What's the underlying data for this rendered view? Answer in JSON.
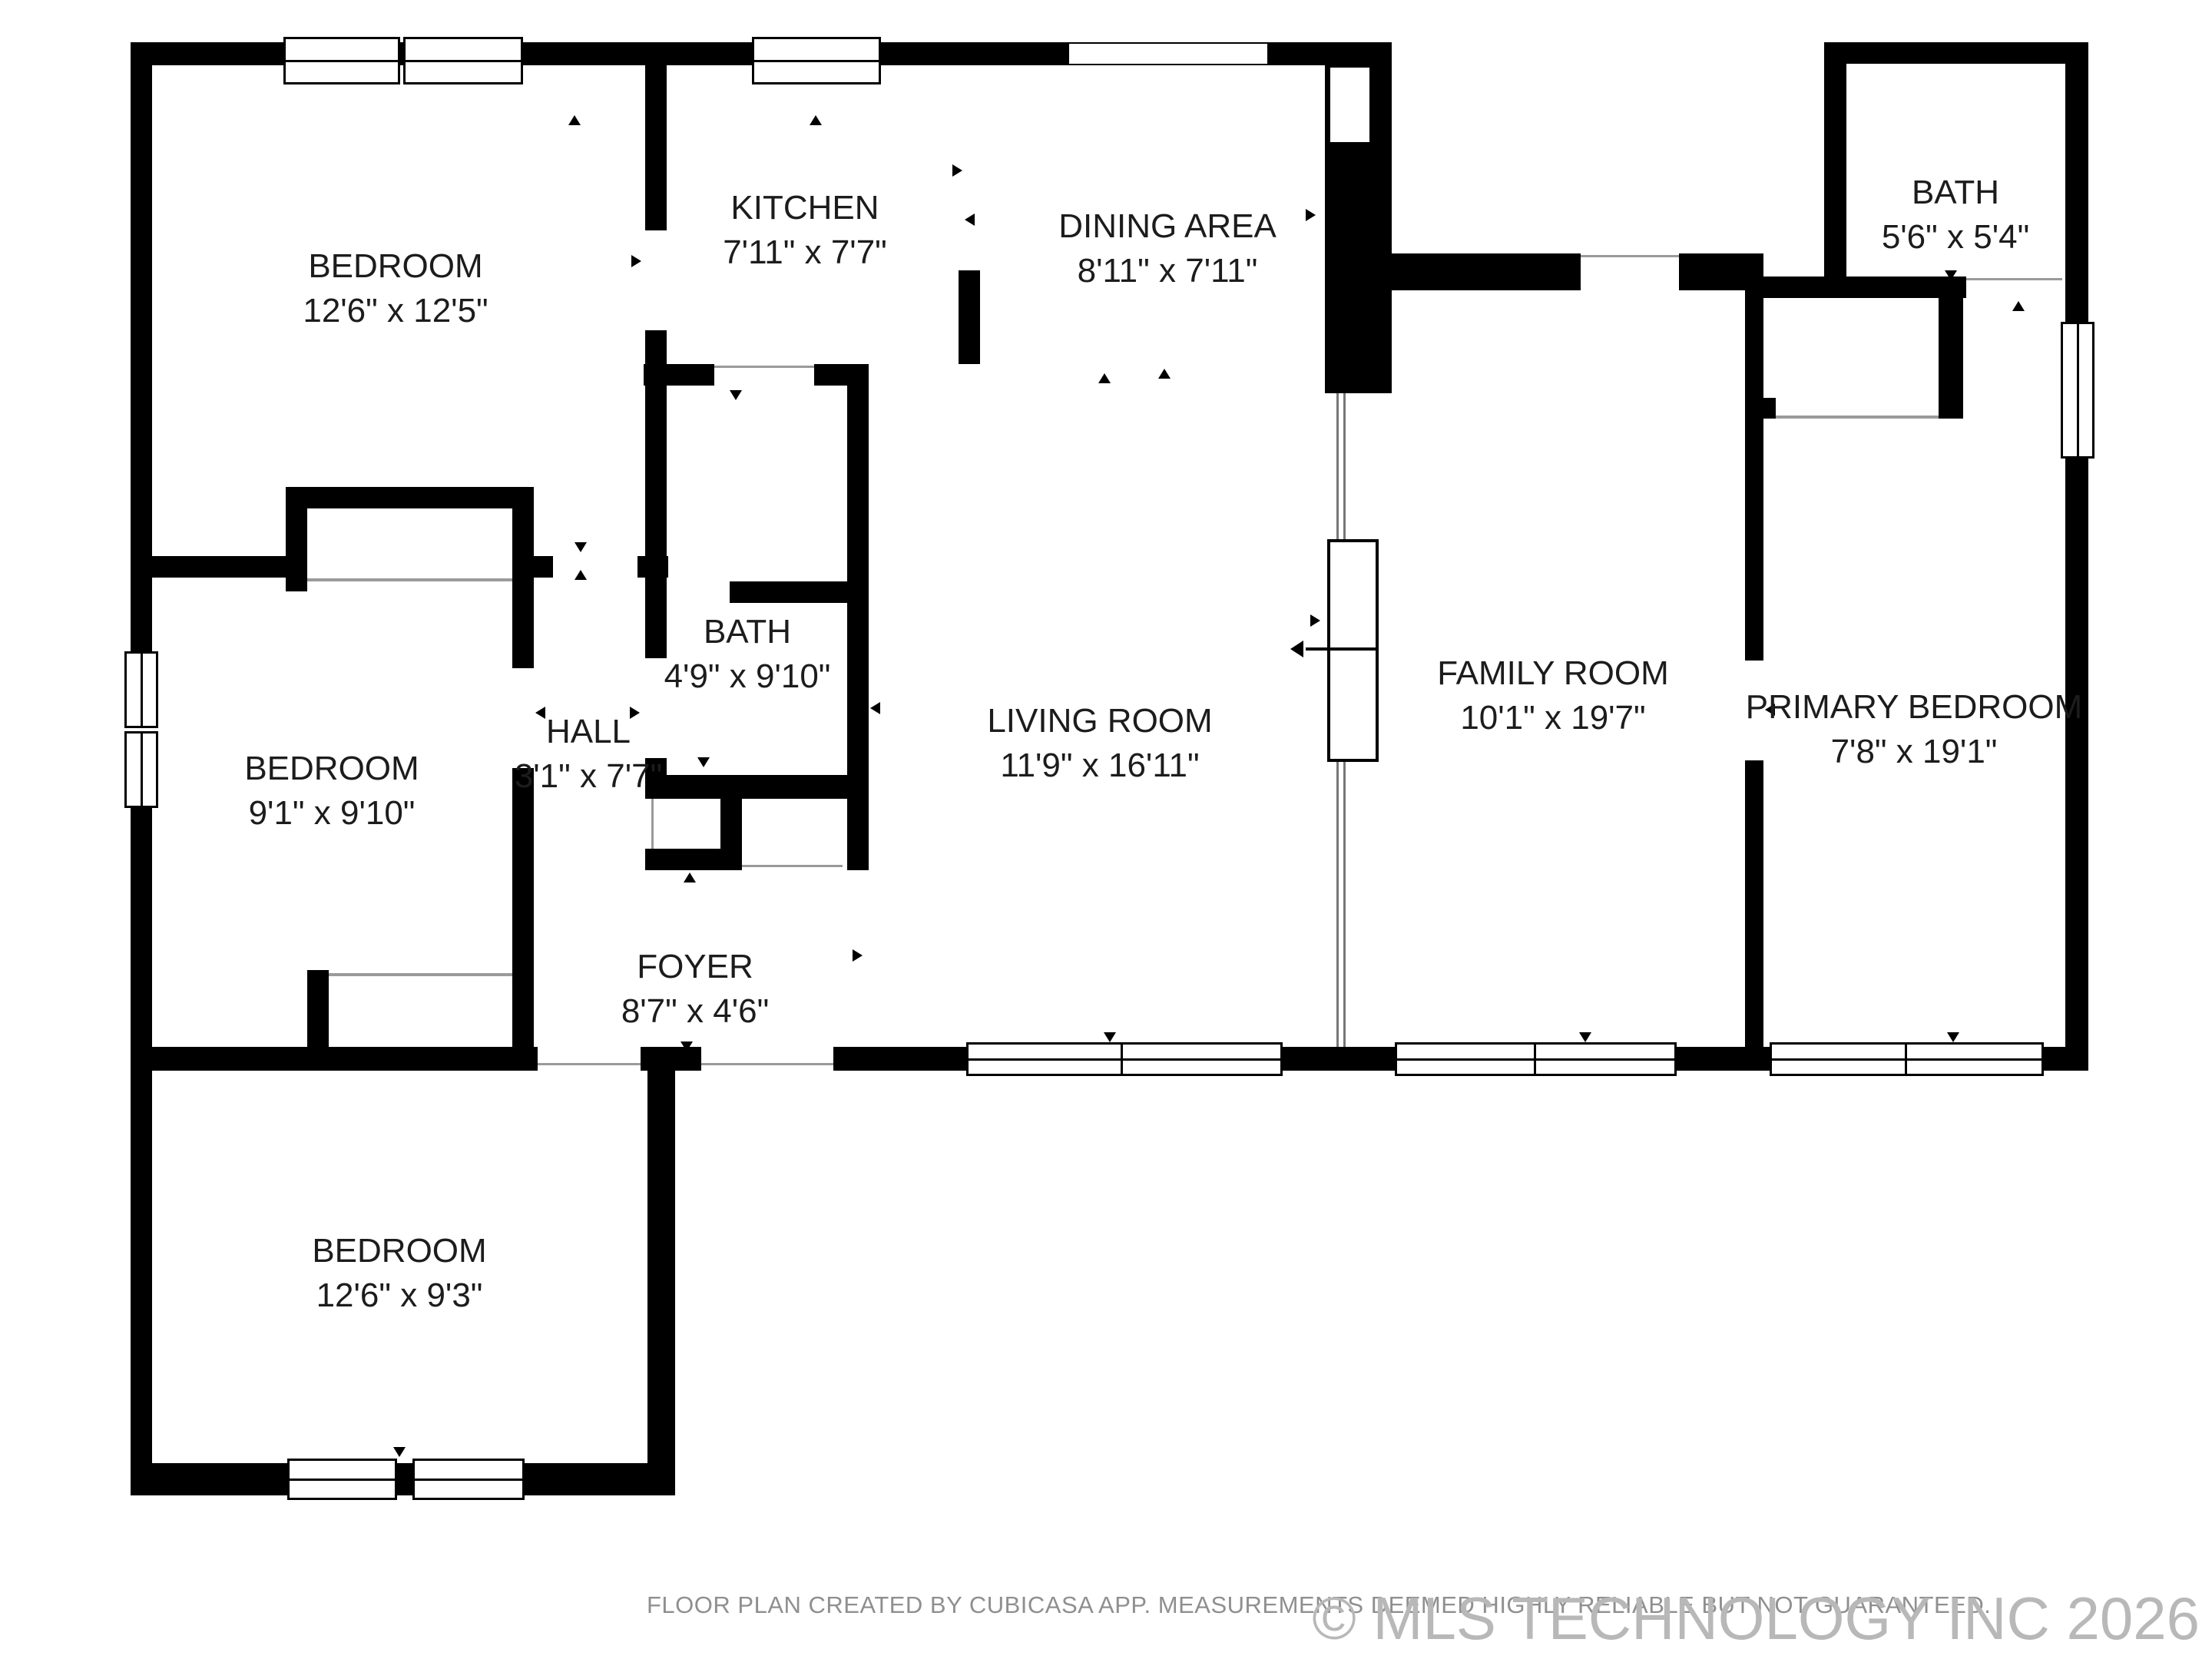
{
  "plan": {
    "type": "floor-plan",
    "rooms": [
      {
        "id": "bedroom-1",
        "name": "BEDROOM",
        "dims": "12'6\" x 12'5\""
      },
      {
        "id": "kitchen",
        "name": "KITCHEN",
        "dims": "7'11\" x 7'7\""
      },
      {
        "id": "dining-area",
        "name": "DINING AREA",
        "dims": "8'11\" x 7'11\""
      },
      {
        "id": "bath-top-right",
        "name": "BATH",
        "dims": "5'6\" x 5'4\""
      },
      {
        "id": "bedroom-2",
        "name": "BEDROOM",
        "dims": "9'1\" x 9'10\""
      },
      {
        "id": "hall",
        "name": "HALL",
        "dims": "3'1\" x 7'7\""
      },
      {
        "id": "bath-hall",
        "name": "BATH",
        "dims": "4'9\" x 9'10\""
      },
      {
        "id": "living-room",
        "name": "LIVING ROOM",
        "dims": "11'9\" x 16'11\""
      },
      {
        "id": "family-room",
        "name": "FAMILY ROOM",
        "dims": "10'1\" x 19'7\""
      },
      {
        "id": "primary-bedroom",
        "name": "PRIMARY BEDROOM",
        "dims": "7'8\" x 19'1\""
      },
      {
        "id": "foyer",
        "name": "FOYER",
        "dims": "8'7\" x 4'6\""
      },
      {
        "id": "bedroom-3",
        "name": "BEDROOM",
        "dims": "12'6\" x 9'3\""
      }
    ],
    "footer": {
      "disclaimer": "FLOOR PLAN CREATED BY CUBICASA APP. MEASUREMENTS DEEMED HIGHLY RELIABLE BUT NOT GUARANTEED.",
      "watermark": "© MLS TECHNOLOGY INC 2026"
    },
    "colors": {
      "wall": "#000000",
      "label": "#1c1c1c",
      "disclaimer": "#8f8f8f",
      "watermark": "#b8b8b8"
    }
  }
}
